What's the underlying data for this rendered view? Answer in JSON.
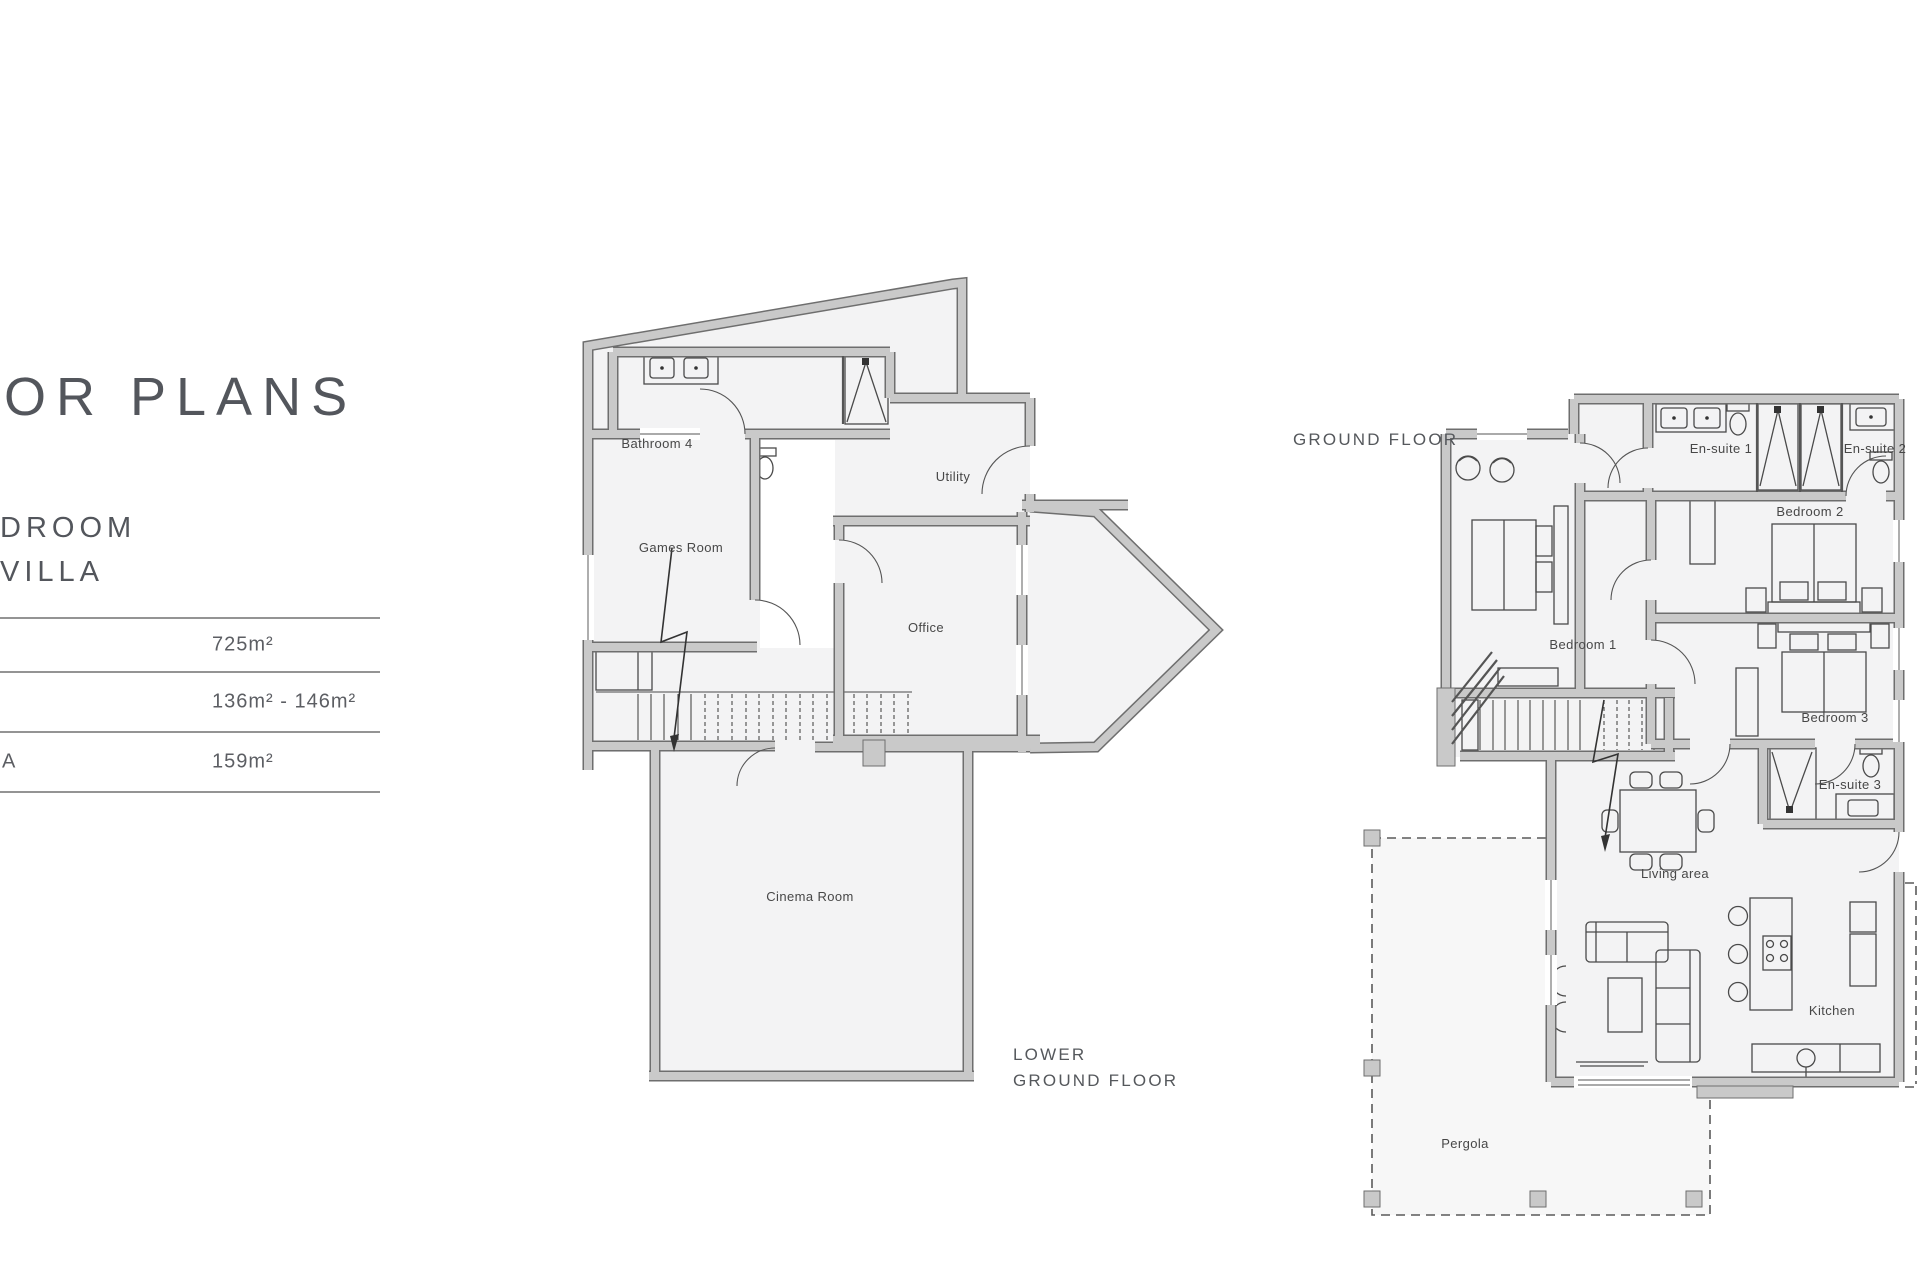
{
  "page": {
    "heading_fragment": "OR PLANS",
    "watermark": "S H"
  },
  "property": {
    "name_line1": "DROOM",
    "name_line2": "VILLA"
  },
  "area_table": {
    "rows": [
      {
        "label": "",
        "value": "725m²"
      },
      {
        "label": "",
        "value": "136m² - 146m²"
      },
      {
        "label": "A",
        "value": "159m²"
      }
    ]
  },
  "plans": {
    "lower": {
      "label_line1": "LOWER",
      "label_line2": "GROUND FLOOR",
      "rooms": {
        "games": "Games Room",
        "bathroom4": "Bathroom 4",
        "utility": "Utility",
        "office": "Office",
        "cinema": "Cinema Room"
      }
    },
    "ground": {
      "label": "GROUND FLOOR",
      "rooms": {
        "bedroom1": "Bedroom 1",
        "bedroom2": "Bedroom 2",
        "bedroom3": "Bedroom 3",
        "ensuite1": "En-suite 1",
        "ensuite2": "En-suite 2",
        "ensuite3": "En-suite 3",
        "living": "Living area",
        "kitchen": "Kitchen",
        "pergola": "Pergola"
      }
    }
  },
  "colors": {
    "wall_fill": "#c9c9c9",
    "wall_edge": "#6e6e6e",
    "room_fill": "#f3f3f4",
    "heading": "#53565c",
    "table_line": "#949494",
    "label": "#474747"
  }
}
